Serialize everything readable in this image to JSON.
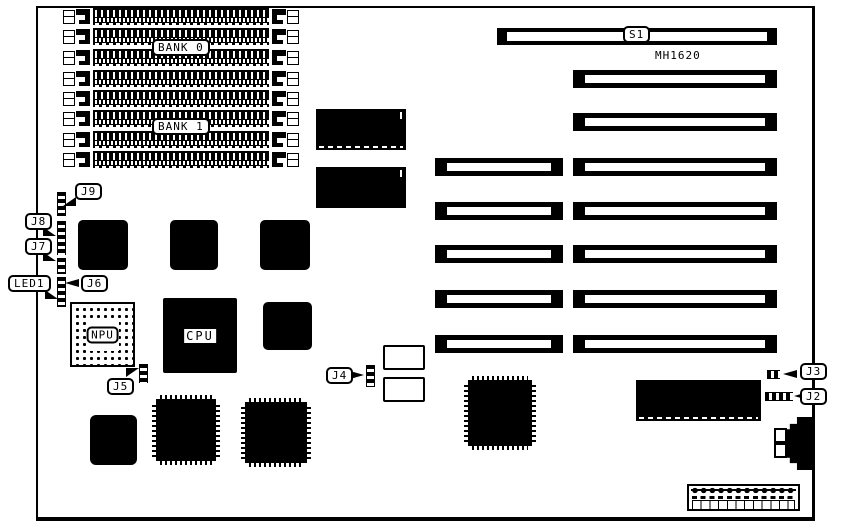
{
  "board": {
    "model_label": "MH1620",
    "memory": {
      "bank0_label": "BANK 0",
      "bank1_label": "BANK 1",
      "simm_socket_count": 8
    },
    "slots": {
      "s1_label": "S1",
      "long_slot_count": 7,
      "short_slot_count": 5
    },
    "chips": {
      "cpu_label": "CPU",
      "npu_label": "NPU"
    },
    "jumpers": {
      "j2": "J2",
      "j3": "J3",
      "j4": "J4",
      "j5": "J5",
      "j6": "J6",
      "j7": "J7",
      "j8": "J8",
      "j9": "J9",
      "led1": "LED1"
    },
    "colors": {
      "ink": "#000000",
      "paper": "#ffffff"
    }
  }
}
